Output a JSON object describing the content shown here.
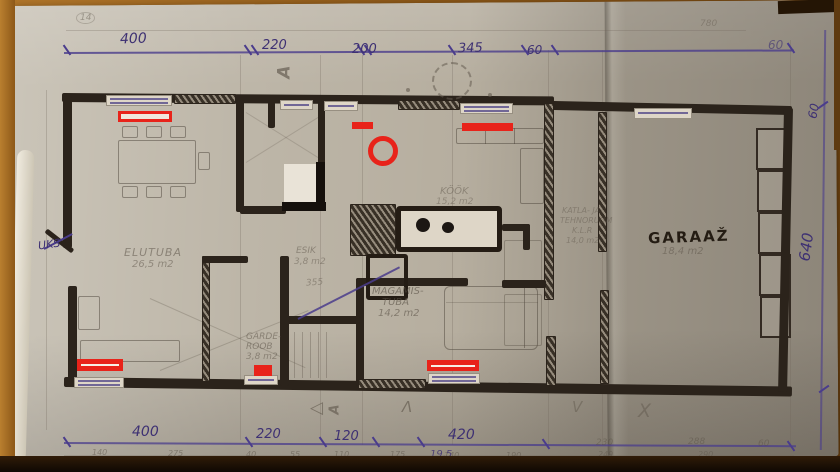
{
  "photo": {
    "description": "hand-drawn house floor plan sketch on photocopied paper, photographed on a wooden desk, with red marker highlights",
    "colors": {
      "wood": "#8d5818",
      "paper": "#b6ae9f",
      "ink_blue": "#3e3173",
      "marker_black": "#2b231b",
      "pencil": "#58463f",
      "red_annotation": "#e8231a"
    }
  },
  "dims": {
    "top": [
      "400",
      "220",
      "200",
      "345",
      "60"
    ],
    "top_far": "60",
    "top_pencil_circled": "14",
    "top_pencil_faint": "780",
    "bottom": [
      "400",
      "220",
      "120",
      "420"
    ],
    "bottom_pencil": [
      "140",
      "275",
      "40",
      "55",
      "110",
      "175",
      "140",
      "190"
    ],
    "bottom_pencil_right": [
      "230",
      "288",
      "60",
      "249",
      "290"
    ],
    "bottom_total": "19,5",
    "right": [
      "60",
      "640"
    ],
    "side_pencil": "355"
  },
  "rooms": {
    "elutuba": {
      "name": "ELUTUBA",
      "area": "26,5 m2"
    },
    "esik": {
      "name": "ESIK",
      "area": "3,8 m2"
    },
    "kook": {
      "name": "KÖÖK",
      "area": "15,2 m2"
    },
    "magamistuba": {
      "line1": "MAGAMIS-",
      "line2": "TUBA",
      "area": "14,2 m2"
    },
    "garderoob": {
      "line1": "GARDE-",
      "line2": "ROOB",
      "area": "3,8 m2"
    },
    "tehnoruum": {
      "line1": "KATLA- JA",
      "line2": "TEHNORUUM",
      "line3": "K.L.R",
      "area": "14,0 m2"
    },
    "garaaz": {
      "name": "GARAAŽ",
      "area": "18,4 m2"
    },
    "door_label": "UKS"
  },
  "markers": {
    "a": "A",
    "lambda": "Λ",
    "triangle": "◁",
    "x": "X",
    "v": "V"
  },
  "annotations": {
    "red": "#e8231a",
    "items": [
      "window-top-left-outline",
      "vent-top-center-bar",
      "circle-mark",
      "window-top-right-bar",
      "window-bottom-left-outline",
      "garderoob-mark",
      "window-bottom-center-outline"
    ]
  }
}
